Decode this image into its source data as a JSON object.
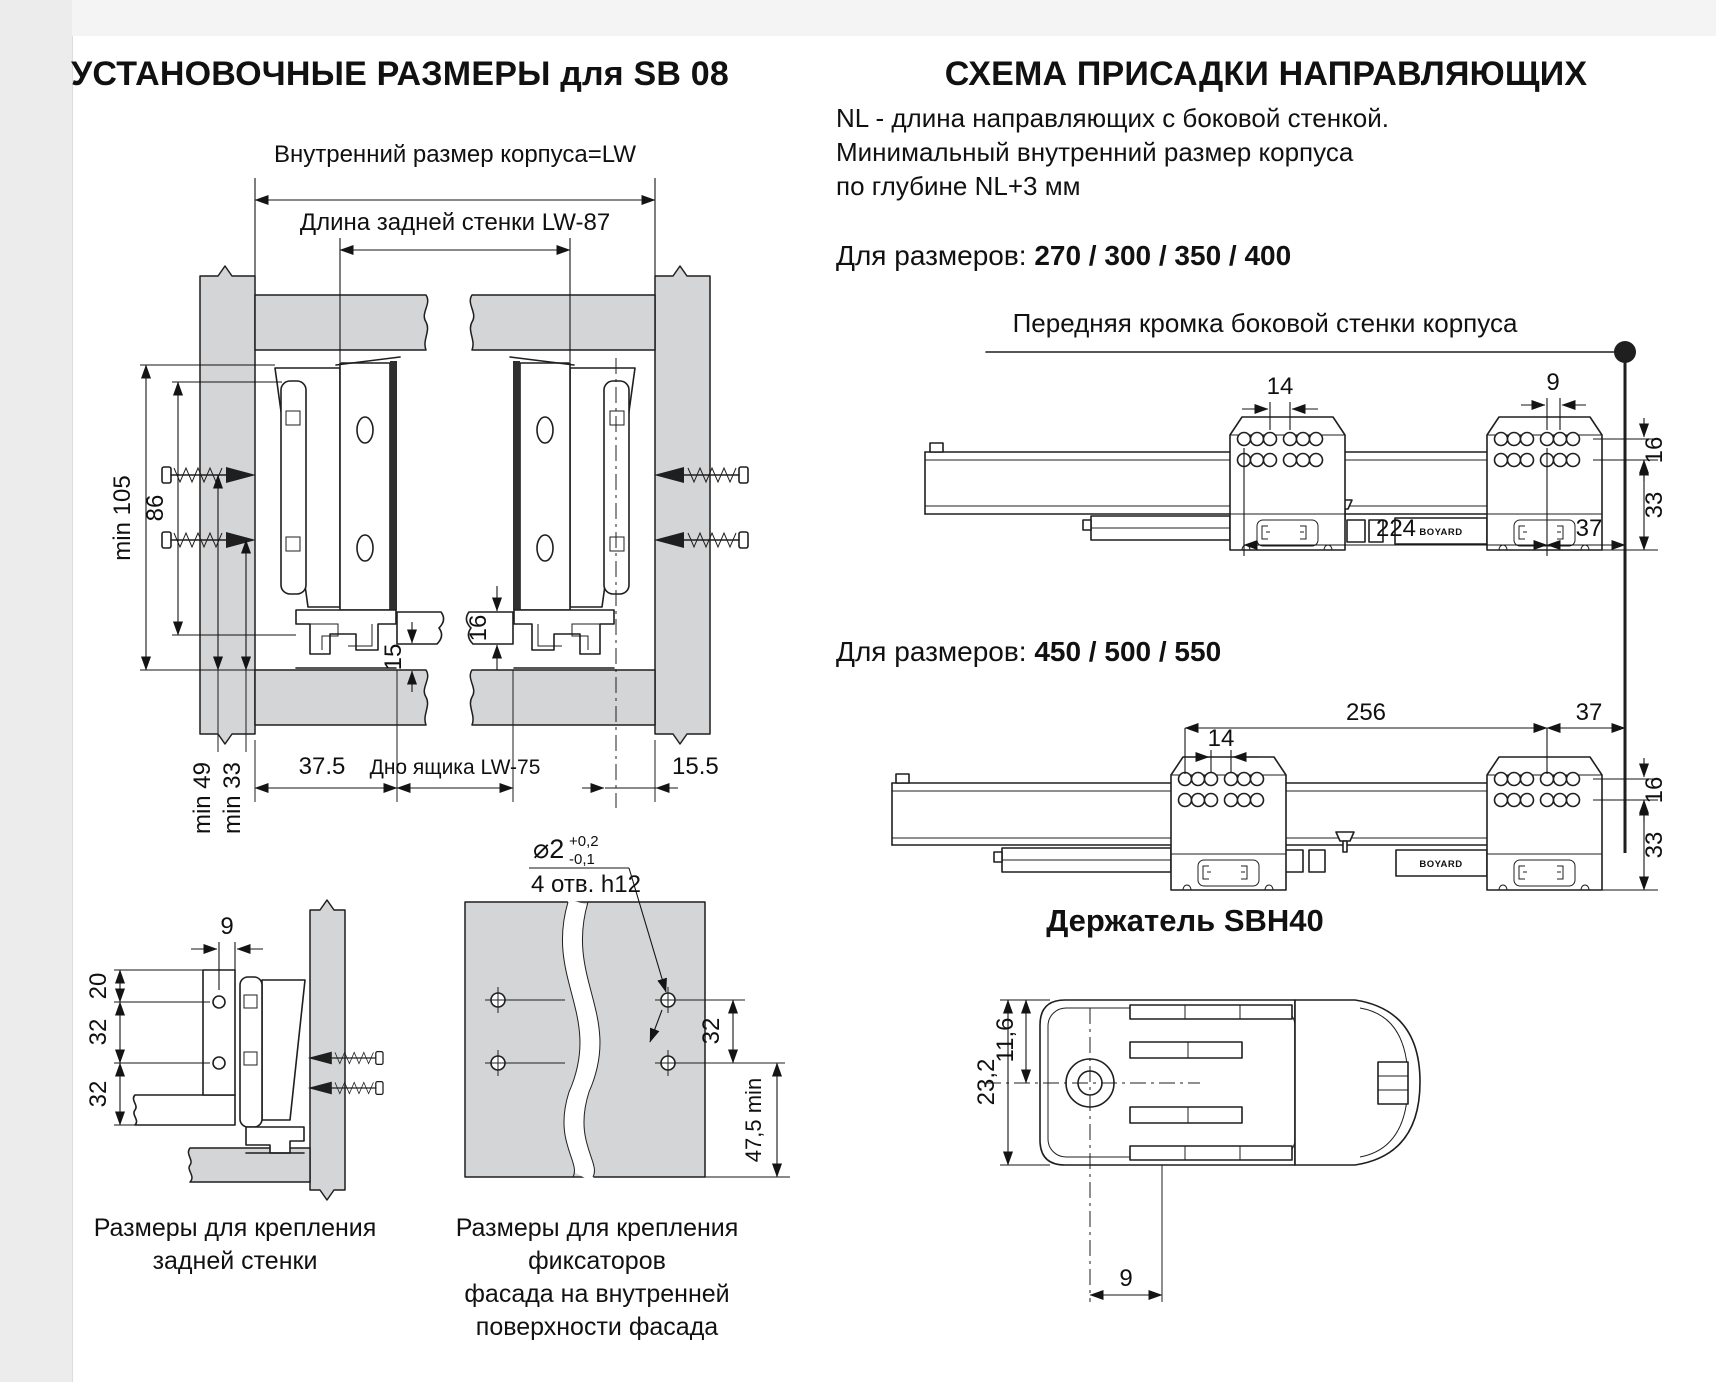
{
  "colors": {
    "ink": "#1f1f1f",
    "panel_fill": "#d3d5d6",
    "background": "#ffffff"
  },
  "left": {
    "title": "УСТАНОВОЧНЫЕ РАЗМЕРЫ для SB 08",
    "dim_inner_width": "Внутренний размер корпуса=LW",
    "dim_back_wall": "Длина задней стенки  LW-87",
    "dims": {
      "min105": "min 105",
      "h86": "86",
      "min49": "min 49",
      "min33": "min 33",
      "t16": "16",
      "t15": "15",
      "w375": "37.5",
      "bottom": "Дно ящика  LW-75",
      "w155": "15.5"
    },
    "backwall": {
      "d9": "9",
      "d20": "20",
      "d32a": "32",
      "d32b": "32",
      "caption": [
        "Размеры  для крепления",
        "задней стенки"
      ]
    },
    "facade": {
      "dia": "⌀2",
      "tol_up": "+0,2",
      "tol_dn": "-0,1",
      "holes": "4 отв. h12",
      "d32": "32",
      "d475": "47,5 min",
      "caption": [
        "Размеры для крепления фиксаторов",
        "фасада на внутренней",
        "поверхности фасада"
      ]
    }
  },
  "right": {
    "title": "СХЕМА ПРИСАДКИ НАПРАВЛЯЮЩИХ",
    "note": [
      "NL - длина направляющих с боковой стенкой.",
      "Минимальный внутренний размер корпуса",
      "по глубине NL+3 мм"
    ],
    "sizes1": {
      "label": "Для размеров:",
      "value": "270 / 300 / 350 / 400"
    },
    "front_edge": "Передняя кромка боковой стенки корпуса",
    "rail1": {
      "d14": "14",
      "d9": "9",
      "d16": "16",
      "d33": "33",
      "d224": "224",
      "d37": "37",
      "brand": "BOYARD"
    },
    "sizes2": {
      "label": "Для размеров:",
      "value": "450 / 500 / 550"
    },
    "rail2": {
      "d14": "14",
      "d16": "16",
      "d33": "33",
      "d256": "256",
      "d37": "37",
      "brand": "BOYARD"
    },
    "holder": {
      "title": "Держатель SBH40",
      "d232": "23,2",
      "d116": "11,6",
      "d9": "9"
    }
  }
}
